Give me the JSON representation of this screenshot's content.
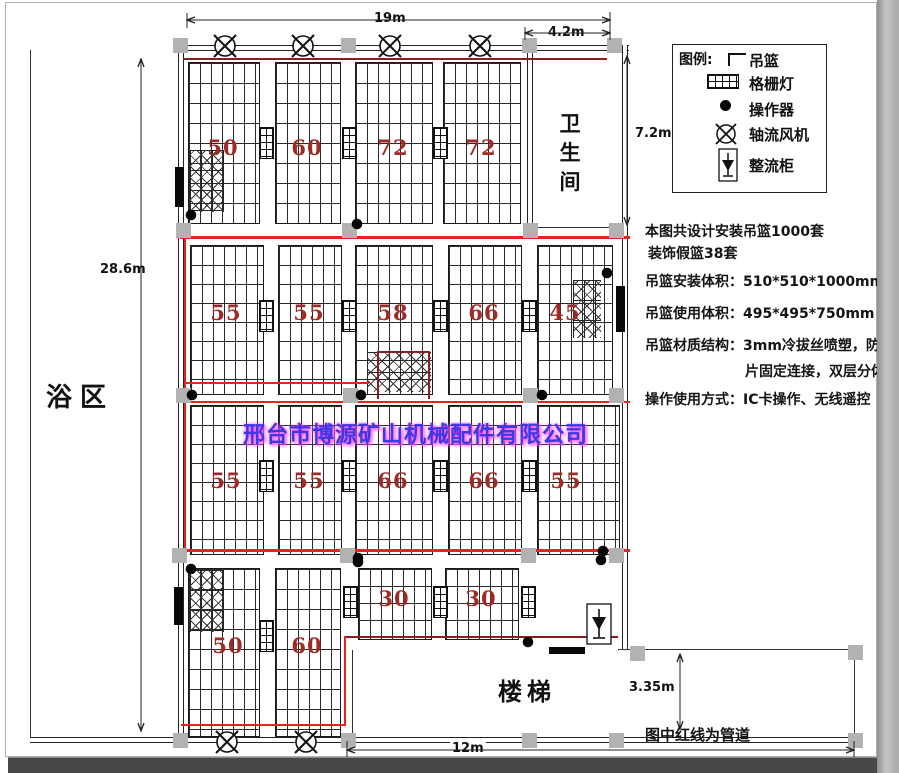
{
  "watermark": "邢台市博源矿山机械配件有限公司",
  "rooms": {
    "bath_area": "浴区",
    "toilet": "卫生间",
    "stairs": "楼梯"
  },
  "legend": {
    "title": "图例:",
    "items": [
      {
        "icon": "basket-icon",
        "label": "吊篮"
      },
      {
        "icon": "grille-light-icon",
        "label": "格栅灯"
      },
      {
        "icon": "operator-icon",
        "label": "操作器"
      },
      {
        "icon": "axial-fan-icon",
        "label": "轴流风机"
      },
      {
        "icon": "rectifier-icon",
        "label": "整流柜"
      }
    ]
  },
  "notes": [
    "本图共设计安装吊篮1000套",
    "装饰假篮38套",
    "吊篮安装体积：510*510*1000mm",
    "吊篮使用体积：495*495*750mm",
    "吊篮材质结构：3mm冷拔丝喷塑，防锈铆",
    "片固定连接，双层分体式",
    "操作使用方式：IC卡操作、无线遥控"
  ],
  "dimensions": {
    "top_width": "19m",
    "toilet_width": "4.2m",
    "toilet_height": "7.2m",
    "left_height": "28.6m",
    "stairs_height": "3.35m",
    "bottom_width": "12m"
  },
  "footer_note": "图中红线为管道",
  "basket_counts": {
    "row1": [
      "50",
      "60",
      "72",
      "72"
    ],
    "row2": [
      "55",
      "55",
      "58",
      "66",
      "45"
    ],
    "row3": [
      "55",
      "55",
      "66",
      "66",
      "55"
    ],
    "row4": [
      "50",
      "60",
      "30",
      "30"
    ]
  },
  "colors": {
    "pipe_red": "#e8231e",
    "pipe_dark_red": "#8b1e1e",
    "count_red": "#9e2b25",
    "watermark_blue": "#3a3ae0",
    "watermark_glow": "#ff50ff",
    "column_gray": "#b2b2b2"
  }
}
